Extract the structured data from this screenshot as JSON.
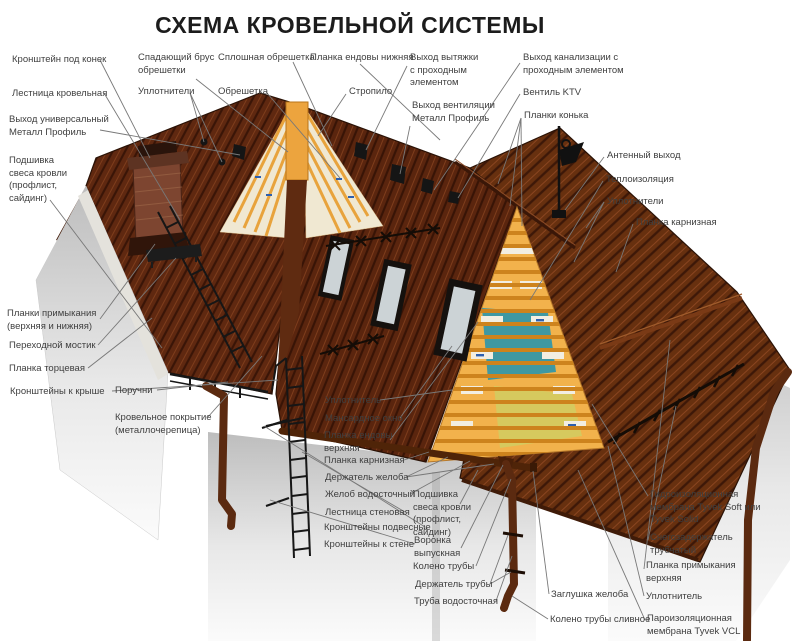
{
  "title": "СХЕМА КРОВЕЛЬНОЙ СИСТЕМЫ",
  "palette": {
    "roof_dark": "#5e2710",
    "roof_edge": "#2a1206",
    "wood_orange": "#eca43e",
    "batten_orange": "#cd831d",
    "insulation_teal": "#3f98a2",
    "insulation_yellow": "#d6c95e",
    "membrane_white": "#f2eee2",
    "membrane_print_blue": "#2e5fae",
    "metal_dark": "#151515",
    "pipe_brown": "#5b2a10",
    "wall_light": "#e9e9e9",
    "label_text": "#3f3f3f",
    "leader_line": "#787878"
  },
  "illustration": {
    "membrane_brand": "Tyvek"
  },
  "labels": [
    {
      "id": "kronshtein-pod-konek",
      "x": 12,
      "y": 54,
      "lines": [
        "Кронштейн под конек"
      ],
      "leaders": [
        [
          100,
          60,
          150,
          158
        ]
      ]
    },
    {
      "id": "lestnitsa-krovelnaya",
      "x": 12,
      "y": 88,
      "lines": [
        "Лестница кровельная"
      ],
      "leaders": [
        [
          104,
          93,
          180,
          220
        ]
      ]
    },
    {
      "id": "vykhod-universalnyi",
      "x": 9,
      "y": 114,
      "lines": [
        "Выход универсальный",
        "Металл Профиль"
      ],
      "leaders": [
        [
          100,
          130,
          240,
          155
        ]
      ]
    },
    {
      "id": "podshivka-svesa-left",
      "x": 9,
      "y": 155,
      "lines": [
        "Подшивка",
        "свеса кровли",
        "(профлист,",
        "сайдинг)"
      ],
      "leaders": [
        [
          50,
          200,
          162,
          348
        ]
      ]
    },
    {
      "id": "planki-primykaniya",
      "x": 7,
      "y": 308,
      "lines": [
        "Планки примыкания",
        "(верхняя и нижняя)"
      ],
      "leaders": [
        [
          100,
          319,
          155,
          244
        ]
      ]
    },
    {
      "id": "perekhodnoi-mostik",
      "x": 9,
      "y": 340,
      "lines": [
        "Переходной мостик"
      ],
      "leaders": [
        [
          98,
          345,
          176,
          258
        ]
      ]
    },
    {
      "id": "planka-tortsevaya",
      "x": 9,
      "y": 363,
      "lines": [
        "Планка торцевая"
      ],
      "leaders": [
        [
          88,
          368,
          152,
          318
        ]
      ]
    },
    {
      "id": "kronshteiny-k-kryshe",
      "x": 10,
      "y": 386,
      "lines": [
        "Кронштейны к крыше"
      ],
      "leaders": [
        [
          112,
          391,
          278,
          380
        ]
      ]
    },
    {
      "id": "poruchni",
      "x": 115,
      "y": 385,
      "lines": [
        "Поручни"
      ],
      "leaders": [
        [
          157,
          390,
          228,
          382
        ]
      ]
    },
    {
      "id": "krovelnoe-pokrytie",
      "x": 115,
      "y": 412,
      "lines": [
        "Кровельное покрытие",
        "(металлочерепица)"
      ],
      "leaders": [
        [
          208,
          417,
          262,
          356
        ]
      ]
    },
    {
      "id": "uplotnitel-mid",
      "x": 325,
      "y": 395,
      "lines": [
        "Уплотнитель"
      ],
      "leaders": [
        [
          380,
          400,
          452,
          390
        ]
      ]
    },
    {
      "id": "mansardnoe-okno",
      "x": 325,
      "y": 413,
      "lines": [
        "Мансардное окно"
      ],
      "leaders": [
        [
          400,
          418,
          452,
          346
        ]
      ]
    },
    {
      "id": "planka-endovy-verkhnyaya",
      "x": 324,
      "y": 430,
      "lines": [
        "Планка ендовы",
        "верхняя"
      ],
      "leaders": [
        [
          390,
          440,
          478,
          322
        ]
      ]
    },
    {
      "id": "planka-karniznaya-mid",
      "x": 324,
      "y": 455,
      "lines": [
        "Планка карнизная"
      ],
      "leaders": [
        [
          404,
          460,
          429,
          452
        ]
      ]
    },
    {
      "id": "derzhatel-zheloba",
      "x": 325,
      "y": 472,
      "lines": [
        "Держатель желоба"
      ],
      "leaders": [
        [
          406,
          477,
          448,
          457
        ],
        [
          406,
          477,
          494,
          464
        ]
      ]
    },
    {
      "id": "zhelob-vodostochnyi",
      "x": 325,
      "y": 489,
      "lines": [
        "Желоб водосточный"
      ],
      "leaders": [
        [
          410,
          494,
          470,
          461
        ]
      ]
    },
    {
      "id": "lestnitsa-stenovaya",
      "x": 325,
      "y": 507,
      "lines": [
        "Лестница стеновая"
      ],
      "leaders": [
        [
          405,
          512,
          302,
          452
        ]
      ]
    },
    {
      "id": "kronshteiny-podvesnye",
      "x": 324,
      "y": 522,
      "lines": [
        "Кронштейны подвесные"
      ],
      "leaders": [
        [
          425,
          527,
          264,
          426
        ]
      ]
    },
    {
      "id": "kronshteiny-k-stene",
      "x": 324,
      "y": 539,
      "lines": [
        "Кронштейны к стене"
      ],
      "leaders": [
        [
          415,
          544,
          270,
          500
        ]
      ]
    },
    {
      "id": "podshivka-svesa-bottom",
      "x": 413,
      "y": 489,
      "lines": [
        "Подшивка",
        "свеса кровли",
        "(профлист,",
        "сайдинг)"
      ],
      "leaders": [
        [
          460,
          504,
          478,
          470
        ]
      ]
    },
    {
      "id": "voronka-vypusknaya",
      "x": 414,
      "y": 535,
      "lines": [
        "Воронка",
        "выпускная"
      ],
      "leaders": [
        [
          461,
          548,
          503,
          465
        ]
      ]
    },
    {
      "id": "koleno-truby",
      "x": 413,
      "y": 561,
      "lines": [
        "Колено трубы"
      ],
      "leaders": [
        [
          476,
          566,
          511,
          479
        ]
      ]
    },
    {
      "id": "derzhatel-truby",
      "x": 415,
      "y": 579,
      "lines": [
        "Держатель трубы"
      ],
      "leaders": [
        [
          490,
          584,
          508,
          535
        ],
        [
          490,
          584,
          511,
          572
        ]
      ]
    },
    {
      "id": "truba-vodostochnaya",
      "x": 414,
      "y": 596,
      "lines": [
        "Труба водосточная"
      ],
      "leaders": [
        [
          496,
          601,
          512,
          556
        ]
      ]
    },
    {
      "id": "zaglushka-zheloba",
      "x": 551,
      "y": 589,
      "lines": [
        "Заглушка желоба"
      ],
      "leaders": [
        [
          549,
          594,
          533,
          471
        ]
      ]
    },
    {
      "id": "koleno-truby-slivnoe",
      "x": 550,
      "y": 614,
      "lines": [
        "Колено трубы сливное"
      ],
      "leaders": [
        [
          548,
          619,
          512,
          596
        ]
      ]
    },
    {
      "id": "gidroizolyatsionnaya-membrana",
      "x": 650,
      "y": 489,
      "lines": [
        "Гидроизоляционная",
        "мембрана Tyvek Soft или",
        "Tyvek Solid"
      ],
      "leaders": [
        [
          648,
          496,
          592,
          404
        ]
      ]
    },
    {
      "id": "snegozaderzhatel",
      "x": 650,
      "y": 532,
      "lines": [
        "Снегозадержатель",
        "трубчатый"
      ],
      "leaders": [
        [
          648,
          540,
          676,
          406
        ]
      ]
    },
    {
      "id": "planka-primykaniya-verkhnyaya",
      "x": 646,
      "y": 560,
      "lines": [
        "Планка примыкания",
        "верхняя"
      ],
      "leaders": [
        [
          644,
          569,
          670,
          340
        ]
      ]
    },
    {
      "id": "uplotnitel-right",
      "x": 646,
      "y": 591,
      "lines": [
        "Уплотнитель"
      ],
      "leaders": [
        [
          644,
          596,
          608,
          446
        ]
      ]
    },
    {
      "id": "paroizolyatsionnaya-membrana",
      "x": 647,
      "y": 613,
      "lines": [
        "Пароизоляционная",
        "мембрана Tyvek VCL"
      ],
      "leaders": [
        [
          645,
          620,
          578,
          470
        ]
      ]
    },
    {
      "id": "spadayushchii-brus",
      "x": 138,
      "y": 52,
      "lines": [
        "Спадающий брус",
        "обрешетки"
      ],
      "leaders": [
        [
          196,
          79,
          288,
          152
        ]
      ]
    },
    {
      "id": "uplotniteli-left",
      "x": 138,
      "y": 86,
      "lines": [
        "Уплотнители"
      ],
      "leaders": [
        [
          190,
          93,
          204,
          142
        ],
        [
          190,
          93,
          222,
          162
        ]
      ]
    },
    {
      "id": "sploshnaya-obreshetka",
      "x": 218,
      "y": 52,
      "lines": [
        "Сплошная обрешетка"
      ],
      "leaders": [
        [
          293,
          62,
          332,
          146
        ]
      ]
    },
    {
      "id": "obreshetka",
      "x": 218,
      "y": 86,
      "lines": [
        "Обрешетка"
      ],
      "leaders": [
        [
          267,
          93,
          340,
          178
        ]
      ]
    },
    {
      "id": "planka-endovy-nizhnyaya",
      "x": 310,
      "y": 52,
      "lines": [
        "Планка ендовы нижняя"
      ],
      "leaders": [
        [
          360,
          64,
          440,
          140
        ]
      ]
    },
    {
      "id": "stropilo",
      "x": 349,
      "y": 86,
      "lines": [
        "Стропило"
      ],
      "leaders": [
        [
          346,
          94,
          318,
          136
        ]
      ]
    },
    {
      "id": "vykhod-vytyazhki",
      "x": 410,
      "y": 52,
      "lines": [
        "Выход вытяжки",
        "с проходным",
        "элементом"
      ],
      "leaders": [
        [
          407,
          66,
          366,
          150
        ]
      ]
    },
    {
      "id": "vykhod-ventilyatsii",
      "x": 412,
      "y": 100,
      "lines": [
        "Выход вентиляции",
        "Металл Профиль"
      ],
      "leaders": [
        [
          410,
          126,
          400,
          174
        ]
      ]
    },
    {
      "id": "vykhod-kanalizatsii",
      "x": 523,
      "y": 52,
      "lines": [
        "Выход канализации с",
        "проходным элементом"
      ],
      "leaders": [
        [
          520,
          63,
          434,
          190
        ]
      ]
    },
    {
      "id": "ventil-ktv",
      "x": 523,
      "y": 87,
      "lines": [
        "Вентиль KTV"
      ],
      "leaders": [
        [
          520,
          94,
          458,
          198
        ]
      ]
    },
    {
      "id": "planki-konka",
      "x": 524,
      "y": 110,
      "lines": [
        "Планки конька"
      ],
      "leaders": [
        [
          521,
          118,
          498,
          184
        ],
        [
          521,
          118,
          510,
          206
        ],
        [
          521,
          118,
          522,
          226
        ]
      ]
    },
    {
      "id": "antennyi-vykhod",
      "x": 607,
      "y": 150,
      "lines": [
        "Антенный выход"
      ],
      "leaders": [
        [
          604,
          157,
          565,
          210
        ]
      ]
    },
    {
      "id": "teploizolyatsiya",
      "x": 606,
      "y": 174,
      "lines": [
        "Теплоизоляция"
      ],
      "leaders": [
        [
          603,
          181,
          530,
          300
        ]
      ]
    },
    {
      "id": "uplotniteli-right",
      "x": 607,
      "y": 196,
      "lines": [
        "Уплотнители"
      ],
      "leaders": [
        [
          604,
          202,
          586,
          228
        ],
        [
          604,
          202,
          574,
          262
        ]
      ]
    },
    {
      "id": "planka-karniznaya-right",
      "x": 636,
      "y": 217,
      "lines": [
        "Планка карнизная"
      ],
      "leaders": [
        [
          633,
          224,
          616,
          272
        ]
      ]
    }
  ]
}
